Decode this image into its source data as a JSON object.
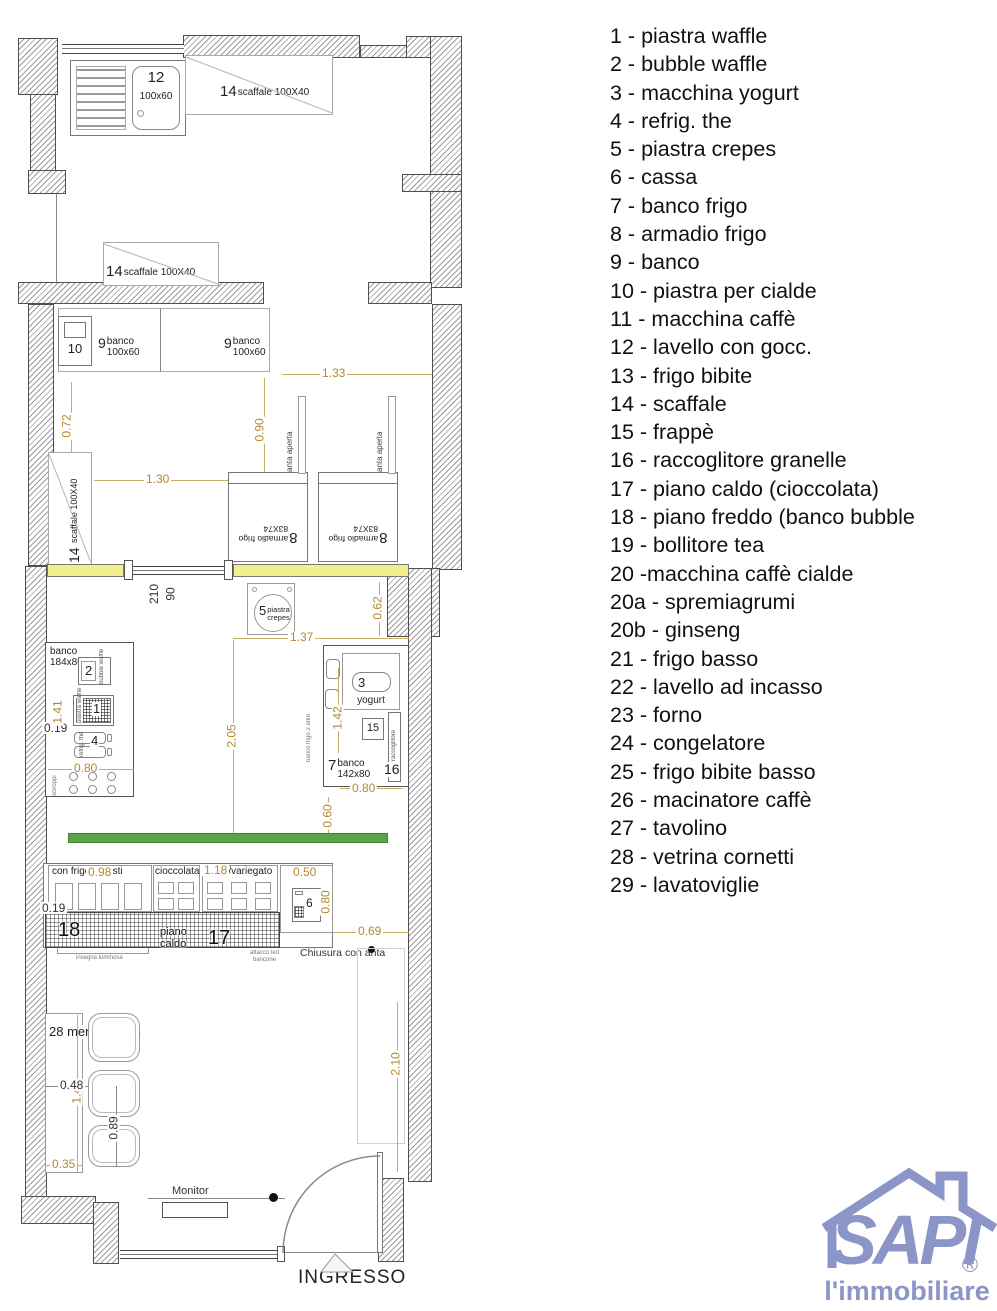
{
  "colors": {
    "dimension_text": "#b5892d",
    "wall_highlight_yellow": "#f2ef8e",
    "bench_green": "#55a546",
    "logo_blue": "#8c95c7"
  },
  "plan": {
    "sink": {
      "num": "12",
      "size": "100x60"
    },
    "shelf": {
      "num": "14",
      "text": "scaffale 100X40"
    },
    "unit10": {
      "num": "10"
    },
    "banco9": {
      "num": "9",
      "name": "banco",
      "size": "100x60"
    },
    "armadio": {
      "num": "8",
      "name": "armadio frigo",
      "size": "83X74"
    },
    "anta_aperta": "anta aperta",
    "door": {
      "height": "210",
      "width": "90"
    },
    "unit5": {
      "num": "5",
      "l1": "piastra",
      "l2": "crepes"
    },
    "counter_left": {
      "l1": "banco",
      "l2": "184x80"
    },
    "unit2": {
      "num": "2",
      "side": "bubble waffle"
    },
    "unit1": {
      "num": "1",
      "side": "piastra waffle"
    },
    "unit4": {
      "num": "4",
      "side": "refrig. the"
    },
    "knobs_side": "sciroppi",
    "unit3": {
      "num": "3",
      "name": "yogurt"
    },
    "unit15": {
      "num": "15"
    },
    "unit16": {
      "num": "16",
      "side": "raccoglitore"
    },
    "counter_right": {
      "num": "7",
      "l1": "banco",
      "l2": "142x80"
    },
    "banco_frigo_ante": "banco frigo 2 ante",
    "front": {
      "sec1": "con frigo 9 gusti",
      "sec2": "cioccolata",
      "sec3": "salse/variegato",
      "cassa": "6",
      "n18": "18",
      "piano_l1": "piano",
      "piano_l2": "caldo",
      "n17": "17",
      "chiusura": "Chiusura con anta",
      "insegna": "insegna luminosa",
      "attacco_l1": "attacco led",
      "attacco_l2": "bancone"
    },
    "seating": {
      "mensola": "28 mensola l.35",
      "monitor": "Monitor",
      "ingresso": "INGRESSO"
    },
    "dims": {
      "d133": "1.33",
      "d072": "0.72",
      "d090": "0.90",
      "d130": "1.30",
      "d062": "0.62",
      "d137": "1.37",
      "d141": "1.41",
      "d019": "0.19",
      "d080": "0.80",
      "d205": "2.05",
      "d142": "1.42",
      "d060": "0.60",
      "d098": "0.98",
      "d118": "1.18",
      "d050": "0.50",
      "d069": "0.69",
      "d048": "0.48",
      "d148": "1.48",
      "d089": "0.89",
      "d035": "0.35",
      "d210": "2.10"
    }
  },
  "legend": {
    "items": [
      "1 - piastra waffle",
      "2 - bubble waffle",
      "3 - macchina yogurt",
      "4 - refrig. the",
      "5 - piastra crepes",
      "6 - cassa",
      "7 - banco frigo",
      "8 - armadio frigo",
      "9 - banco",
      "10 - piastra per cialde",
      "11 - macchina caffè",
      "12 - lavello con gocc.",
      "13 - frigo bibite",
      "14 - scaffale",
      "15 - frappè",
      "16 - raccoglitore granelle",
      "17 - piano caldo (cioccolata)",
      "18 - piano freddo (banco bubble",
      "19 - bollitore tea",
      "20 -macchina caffè cialde",
      "20a - spremiagrumi",
      "20b - ginseng",
      "21 - frigo basso",
      "22 - lavello ad incasso",
      "23 - forno",
      "24 - congelatore",
      "25 - frigo bibite basso",
      "26 - macinatore caffè",
      "27 - tavolino",
      "28 - vetrina cornetti",
      "29 - lavatoviglie"
    ]
  },
  "logo": {
    "brand": "SAPI",
    "registered": "®",
    "tagline": "l'immobiliare"
  }
}
